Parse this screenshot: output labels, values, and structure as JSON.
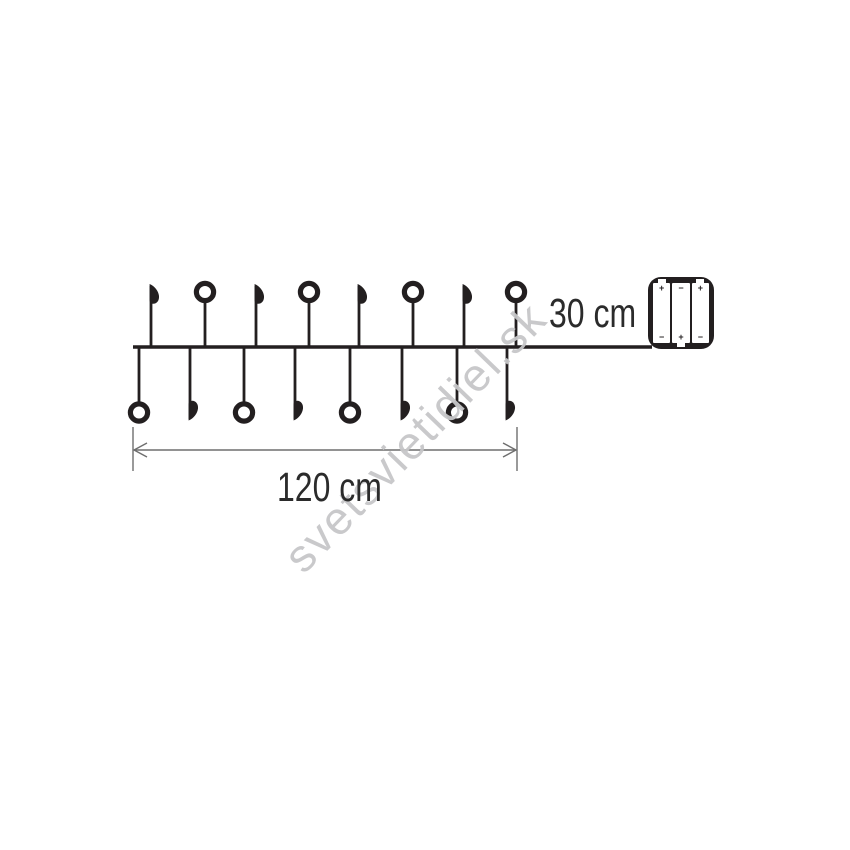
{
  "page": {
    "background": "#ffffff"
  },
  "watermark": {
    "text": "svetsvietidiel.sk",
    "color": "#c7c7c9"
  },
  "diagram": {
    "type": "string-lights-dimension-diagram",
    "line_color": "#231f20",
    "dimension_color": "#6e6e6e",
    "text_color": "#2b2b2b",
    "labels": {
      "string_length": "120 cm",
      "lead_length": "30 cm"
    },
    "wire": {
      "y": 347,
      "x1": 133,
      "x2": 652
    },
    "bulb_count": 16,
    "bulbs": [
      {
        "x": 139,
        "side": "bottom",
        "type": "circle"
      },
      {
        "x": 151,
        "side": "top",
        "type": "leaf"
      },
      {
        "x": 190,
        "side": "bottom",
        "type": "leaf"
      },
      {
        "x": 205,
        "side": "top",
        "type": "circle"
      },
      {
        "x": 244,
        "side": "bottom",
        "type": "circle"
      },
      {
        "x": 256,
        "side": "top",
        "type": "leaf"
      },
      {
        "x": 295,
        "side": "bottom",
        "type": "leaf"
      },
      {
        "x": 309,
        "side": "top",
        "type": "circle"
      },
      {
        "x": 350,
        "side": "bottom",
        "type": "circle"
      },
      {
        "x": 359,
        "side": "top",
        "type": "leaf"
      },
      {
        "x": 402,
        "side": "bottom",
        "type": "leaf"
      },
      {
        "x": 413,
        "side": "top",
        "type": "circle"
      },
      {
        "x": 457,
        "side": "bottom",
        "type": "circle"
      },
      {
        "x": 464,
        "side": "top",
        "type": "leaf"
      },
      {
        "x": 507,
        "side": "bottom",
        "type": "leaf"
      },
      {
        "x": 516,
        "side": "top",
        "type": "circle"
      }
    ],
    "dimension": {
      "x1": 133,
      "x2": 517,
      "y": 450,
      "tick_y1": 427,
      "tick_y2": 471
    },
    "battery_box": {
      "batteries": [
        {
          "top": "+",
          "bottom": "−",
          "nub": "top"
        },
        {
          "top": "−",
          "bottom": "+",
          "nub": "bottom"
        },
        {
          "top": "+",
          "bottom": "−",
          "nub": "top"
        }
      ]
    }
  }
}
